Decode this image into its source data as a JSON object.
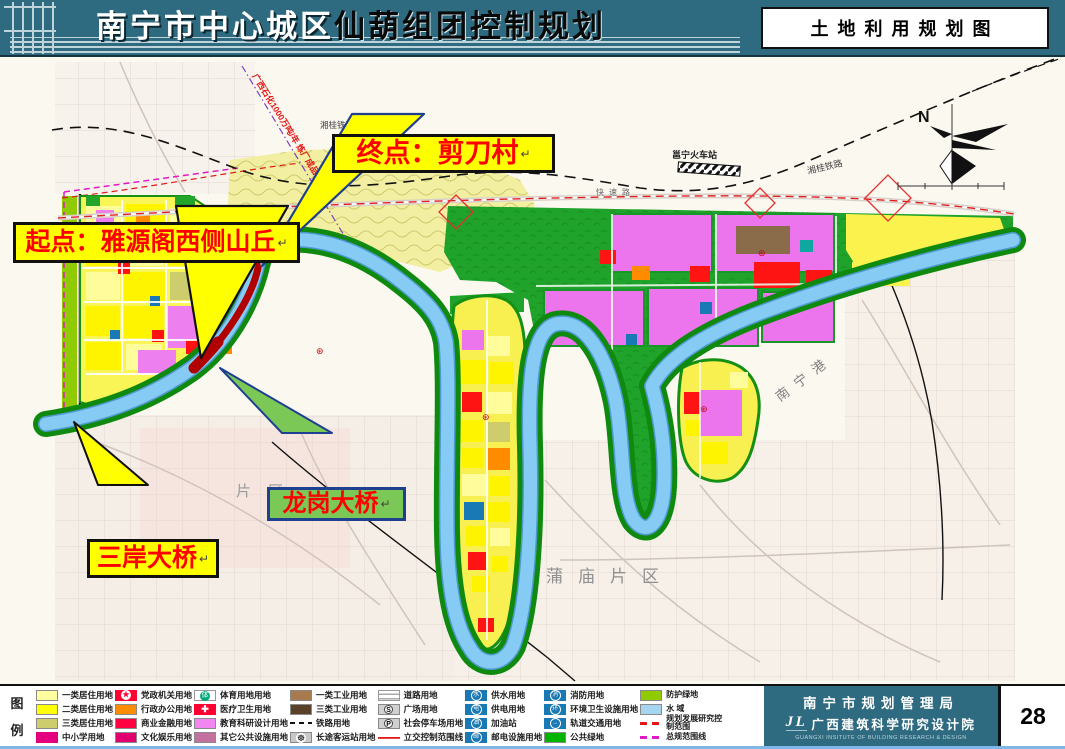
{
  "header": {
    "title_part1": "南宁市中心城区",
    "title_part2": "仙葫组团控制规划",
    "map_type_label": "土地利用规划图"
  },
  "map": {
    "callouts": {
      "end_point": "终点：剪刀村",
      "start_point": "起点：雅源阁西侧山丘",
      "longgang_bridge": "龙岗大桥",
      "sanan_bridge": "三岸大桥",
      "return_mark": "↵"
    },
    "labels": {
      "pipeline_note": "广西石化1000万吨/年 炼厂成品油管线",
      "railway_station": "邕宁火车站",
      "xianggui_railway_west": "湘桂铁路",
      "xianggui_railway_east": "湘桂铁路",
      "expressway": "快速路",
      "nanning_port": "南宁港",
      "pumiao_district": "蒲庙片区",
      "district_partial": "片区",
      "north": "N"
    }
  },
  "legend": {
    "title_chars": [
      "图",
      "例"
    ],
    "columns": [
      {
        "items": [
          {
            "label": "一类居住用地",
            "swatch": "fill",
            "color": "#FFFF9E"
          },
          {
            "label": "二类居住用地",
            "swatch": "fill",
            "color": "#FFFF00"
          },
          {
            "label": "三类居住用地",
            "swatch": "fill",
            "color": "#CDCD6E"
          },
          {
            "label": "中小学用地",
            "swatch": "school",
            "color": "#E3007E",
            "glyph": "⊛⊛"
          }
        ]
      },
      {
        "items": [
          {
            "label": "党政机关用地",
            "swatch": "circle-star",
            "color": "#FF0033",
            "glyph": "★"
          },
          {
            "label": "行政办公用地",
            "swatch": "fill",
            "color": "#FF8C00"
          },
          {
            "label": "商业金融用地",
            "swatch": "fill",
            "color": "#FF0040"
          },
          {
            "label": "文化娱乐用地",
            "swatch": "fill",
            "color": "#E0006E"
          }
        ]
      },
      {
        "items": [
          {
            "label": "体育用地用地",
            "swatch": "circle-green",
            "color": "#00A878",
            "glyph": "体"
          },
          {
            "label": "医疗卫生用地",
            "swatch": "cross",
            "color": "#FF0033",
            "glyph": "✚"
          },
          {
            "label": "教育科研设计用地",
            "swatch": "fill",
            "color": "#F287F2"
          },
          {
            "label": "其它公共设施用地",
            "swatch": "fill",
            "color": "#C4719F"
          }
        ]
      },
      {
        "items": [
          {
            "label": "一类工业用地",
            "swatch": "fill",
            "color": "#A87B4F"
          },
          {
            "label": "三类工业用地",
            "swatch": "fill",
            "color": "#5A4228"
          },
          {
            "label": "铁路用地",
            "swatch": "dash-black"
          },
          {
            "label": "长途客运站用地",
            "swatch": "wheel",
            "glyph": "☸"
          }
        ]
      },
      {
        "items": [
          {
            "label": "道路用地",
            "swatch": "road"
          },
          {
            "label": "广场用地",
            "swatch": "circle-gray",
            "glyph": "S"
          },
          {
            "label": "社会停车场用地",
            "swatch": "circle-gray",
            "glyph": "P"
          },
          {
            "label": "立交控制范围线",
            "swatch": "line-red"
          }
        ]
      },
      {
        "items": [
          {
            "label": "供水用地",
            "swatch": "circle-blue",
            "color": "#1879B4",
            "glyph": "水"
          },
          {
            "label": "供电用地",
            "swatch": "circle-blue",
            "color": "#1879B4",
            "glyph": "电"
          },
          {
            "label": "加油站",
            "swatch": "circle-blue",
            "color": "#1879B4",
            "glyph": "油"
          },
          {
            "label": "邮电设施用地",
            "swatch": "circle-blue",
            "color": "#1879B4",
            "glyph": "邮"
          }
        ]
      },
      {
        "items": [
          {
            "label": "消防用地",
            "swatch": "circle-blue",
            "color": "#1879B4",
            "glyph": "消"
          },
          {
            "label": "环境卫生设施用地",
            "swatch": "circle-blue",
            "color": "#1879B4",
            "glyph": "环"
          },
          {
            "label": "轨道交通用地",
            "swatch": "circle-blue",
            "color": "#1879B4",
            "glyph": "→"
          },
          {
            "label": "公共绿地",
            "swatch": "fill",
            "color": "#00B400"
          }
        ]
      },
      {
        "items": [
          {
            "label": "防护绿地",
            "swatch": "fill",
            "color": "#8FCB00"
          },
          {
            "label": "水    域",
            "swatch": "fill",
            "color": "#A5D5F0"
          },
          {
            "label": "规划发展研究控制范围",
            "swatch": "dash-red"
          },
          {
            "label": "总规范围线",
            "swatch": "dash-magenta"
          }
        ]
      }
    ]
  },
  "footer": {
    "agency": "南宁市规划管理局",
    "institute": "广西建筑科学研究设计院",
    "institute_en": "GUANGXI INSITUTE OF BUILDING RESEARCH & DESIGN",
    "logo_mark": "JL",
    "page_number": "28"
  }
}
